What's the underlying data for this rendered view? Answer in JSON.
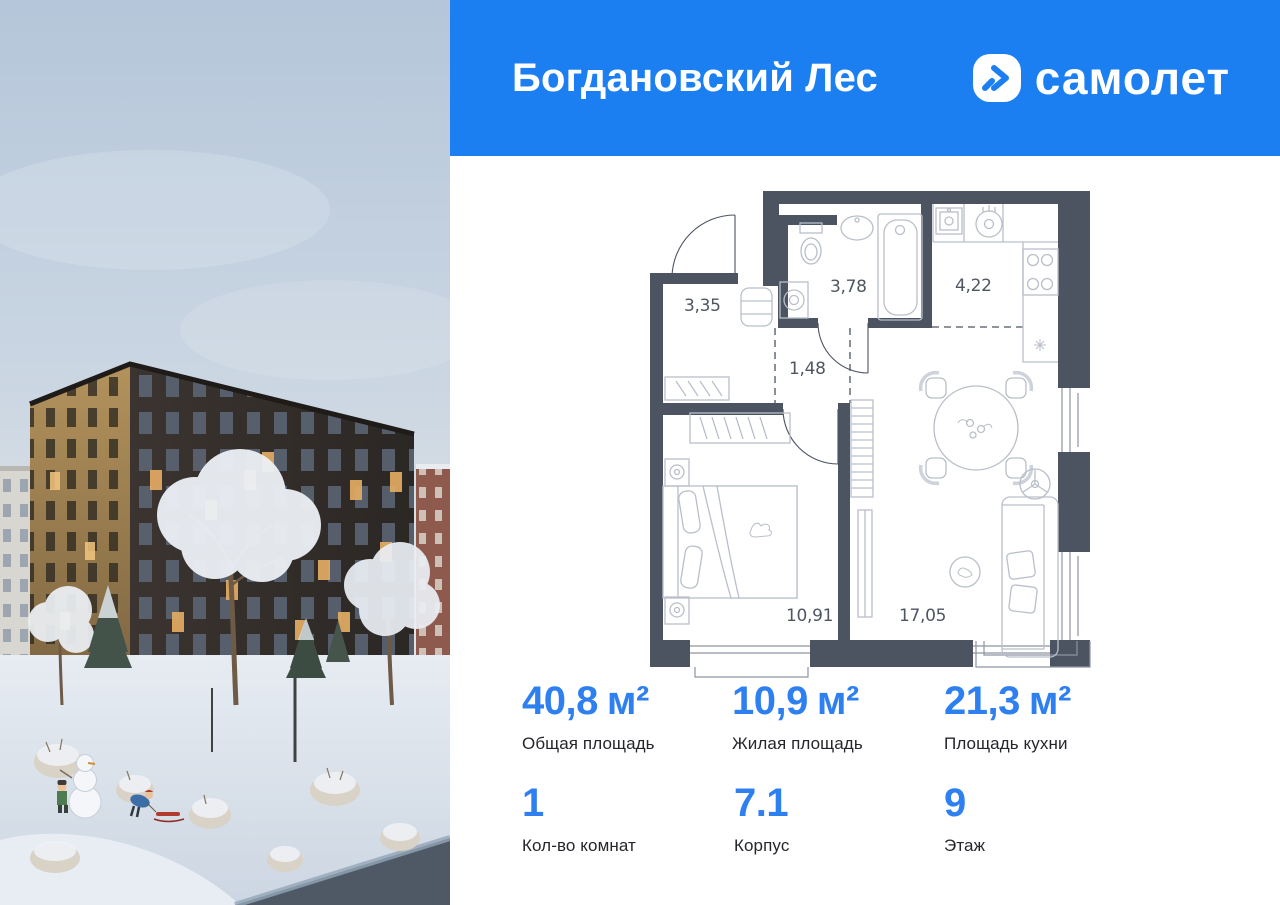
{
  "header": {
    "title": "Богдановский Лес",
    "brand": "самолет"
  },
  "plan": {
    "rooms": [
      {
        "name": "hallway",
        "area": "3,35"
      },
      {
        "name": "bathroom",
        "area": "3,78"
      },
      {
        "name": "kitchen",
        "area": "4,22"
      },
      {
        "name": "corridor",
        "area": "1,48"
      },
      {
        "name": "bedroom",
        "area": "10,91"
      },
      {
        "name": "living-room",
        "area": "17,05"
      }
    ]
  },
  "stats": {
    "row1": [
      {
        "value": "40,8",
        "unit": "м²",
        "label": "Общая площадь"
      },
      {
        "value": "10,9",
        "unit": "м²",
        "label": "Жилая площадь"
      },
      {
        "value": "21,3",
        "unit": "м²",
        "label": "Площадь кухни"
      }
    ],
    "row2": [
      {
        "value": "1",
        "label": "Кол-во комнат"
      },
      {
        "value": "7.1",
        "label": "Корпус"
      },
      {
        "value": "9",
        "label": "Этаж"
      }
    ]
  },
  "colors": {
    "header_blue": "#1b7ff2",
    "accent_blue": "#2e80f1",
    "wall_dark": "#4c5462"
  }
}
